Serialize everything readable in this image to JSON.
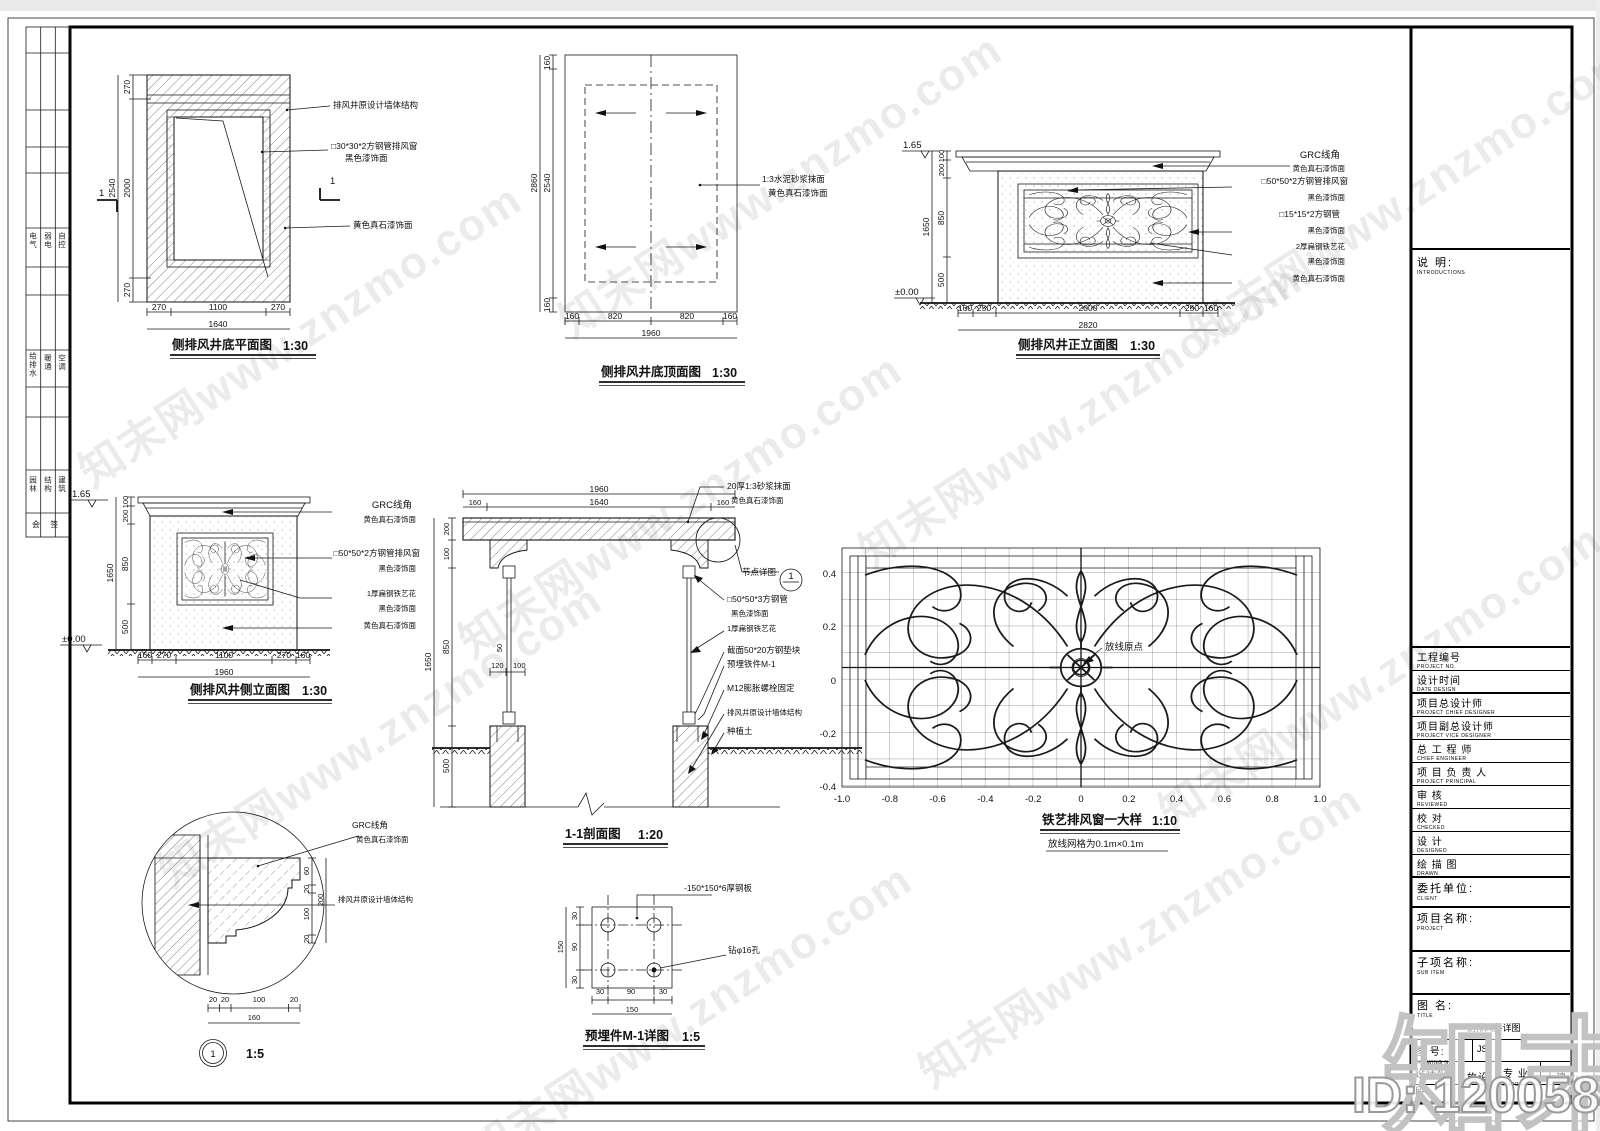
{
  "wm": {
    "tile": "知末网www.znzmo.com",
    "logo": "知末",
    "id": "ID: 1200584684"
  },
  "strip": {
    "cells": [
      "电气",
      "弱电",
      "自控",
      "给排水",
      "暖通",
      "空调",
      "园林",
      "结构",
      "建筑"
    ],
    "last": "会 签"
  },
  "f1": {
    "title": "侧排风井底平面图",
    "scale": "1:30",
    "mark": "1",
    "dl": [
      "270",
      "2000",
      "270",
      "2540"
    ],
    "db": [
      "270",
      "1100",
      "270",
      "1640"
    ],
    "lb": [
      "排风井原设计墙体结构",
      "□30*30*2方钢管排风窗",
      "黑色漆饰面",
      "黄色真石漆饰面"
    ]
  },
  "f2": {
    "title": "侧排风井底顶面图",
    "scale": "1:30",
    "dl": [
      "160",
      "2540",
      "160",
      "2860"
    ],
    "db": [
      "160",
      "820",
      "820",
      "160",
      "1960"
    ],
    "lb": [
      "1:3水泥砂浆抹面",
      "黄色真石漆饰面"
    ]
  },
  "f3": {
    "title": "侧排风井正立面图",
    "scale": "1:30",
    "lv": [
      "1.65",
      "±0.00"
    ],
    "dl": [
      "100",
      "200",
      "850",
      "500",
      "1650"
    ],
    "db": [
      "160",
      "250",
      "2000",
      "250",
      "160",
      "2820"
    ],
    "lb": [
      "GRC线角",
      "黄色真石漆饰面",
      "□50*50*2方钢管排风窗",
      "黑色漆饰面",
      "□15*15*2方钢管",
      "黑色漆饰面",
      "2厚扁钢铁艺花",
      "黑色漆饰面",
      "黄色真石漆饰面"
    ]
  },
  "f4": {
    "title": "侧排风井侧立面图",
    "scale": "1:30",
    "lv": [
      "1.65",
      "±0.00"
    ],
    "dl": [
      "100",
      "200",
      "850",
      "500",
      "1650"
    ],
    "db": [
      "160",
      "270",
      "1100",
      "270",
      "160",
      "1960"
    ],
    "lb": [
      "GRC线角",
      "黄色真石漆饰面",
      "□50*50*2方钢管排风窗",
      "黑色漆饰面",
      "1厚扁钢铁艺花",
      "黑色漆饰面",
      "黄色真石漆饰面"
    ]
  },
  "f5": {
    "title": "1-1剖面图",
    "scale": "1:20",
    "dt": [
      "1960",
      "1640",
      "160",
      "160"
    ],
    "dl": [
      "200",
      "100",
      "850",
      "500",
      "1650"
    ],
    "ds": [
      "50",
      "120",
      "100"
    ],
    "node": {
      "label": "节点详图",
      "num": "1"
    },
    "lb": [
      "20厚1:3砂浆抹面",
      "黄色真石漆饰面",
      "□50*50*3方钢管",
      "黑色漆饰面",
      "1厚扁钢铁艺花",
      "截面50*20方钢垫块",
      "预埋铁件M-1",
      "M12膨胀螺栓固定",
      "排风井原设计墙体结构",
      "种植土"
    ]
  },
  "f6": {
    "title": "铁艺排风窗一大样",
    "scale": "1:10",
    "sub": "放线网格为0.1m×0.1m",
    "origin": "放线原点",
    "xt": [
      "-1.0",
      "-0.8",
      "-0.6",
      "-0.4",
      "-0.2",
      "0",
      "0.2",
      "0.4",
      "0.6",
      "0.8",
      "1.0"
    ],
    "yt": [
      "0.4",
      "0.2",
      "0",
      "-0.2",
      "-0.4"
    ]
  },
  "f7": {
    "num": "1",
    "scale": "1:5",
    "dr": [
      "60",
      "20",
      "100",
      "20",
      "200"
    ],
    "db": [
      "20",
      "20",
      "100",
      "20",
      "160"
    ],
    "lb": [
      "GRC线角",
      "黄色真石漆饰面",
      "排风井原设计墙体结构"
    ]
  },
  "f8": {
    "title": "预埋件M-1详图",
    "scale": "1:5",
    "dl": [
      "30",
      "90",
      "30",
      "150"
    ],
    "db": [
      "30",
      "90",
      "30",
      "150"
    ],
    "lb": [
      "-150*150*6厚钢板",
      "钻φ16孔"
    ]
  },
  "tb": {
    "intro_cn": "说  明:",
    "intro_en": "INTRODUCTIONS",
    "rows": [
      {
        "cn": "工程编号",
        "en": "PROJECT NO."
      },
      {
        "cn": "设计时间",
        "en": "DATE DESIGN"
      },
      {
        "cn": "项目总设计师",
        "en": "PROJECT CHIEF DESIGNER"
      },
      {
        "cn": "项目副总设计师",
        "en": "PROJECT VICE DESIGNER"
      },
      {
        "cn": "总 工 程 师",
        "en": "CHIEF ENGINEER"
      },
      {
        "cn": "项 目 负 责 人",
        "en": "PROJECT PRINCIPAL"
      },
      {
        "cn": "审    核",
        "en": "REVIEWED"
      },
      {
        "cn": "校    对",
        "en": "CHECKED"
      },
      {
        "cn": "设    计",
        "en": "DESIGNED"
      },
      {
        "cn": "绘 描 图",
        "en": "DRAWN"
      }
    ],
    "client_cn": "委托单位:",
    "client_en": "CLIENT",
    "project_cn": "项目名称:",
    "project_en": "PROJECT",
    "subitem_cn": "子项名称:",
    "subitem_en": "SUB ITEM",
    "title_cn": "图  名:",
    "title_en": "TITLE",
    "title_value": "侧排风井详图",
    "no_cn": "图  号:",
    "no_en": "DRAWING NO.",
    "no_value": "JS-",
    "phase_cn": "设计阶段:",
    "phase_en": "PHASE",
    "phase_value": "施设",
    "major_cn": "专  业:",
    "major_en": "MAJOR",
    "major_value": "土建"
  }
}
